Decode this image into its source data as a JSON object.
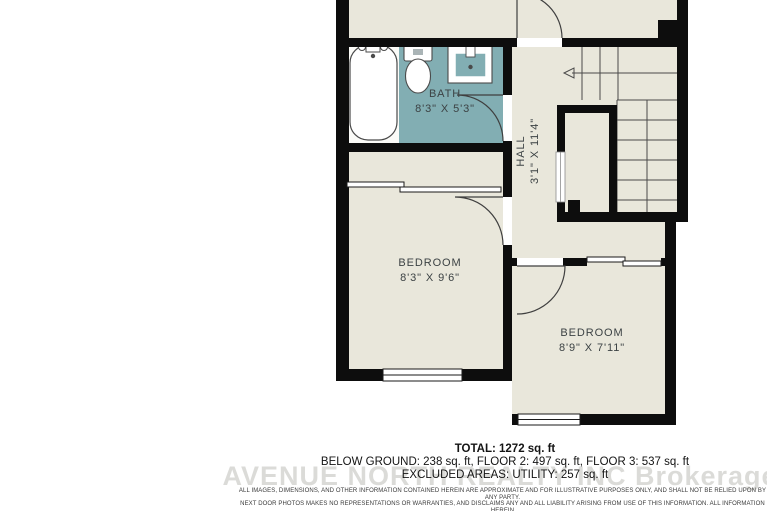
{
  "colors": {
    "wall": "#0d0d0d",
    "floor": "#e9e7db",
    "bath_floor": "#82aeb3",
    "label_text": "#3c4244",
    "watermark_gray": "#b9b9b3"
  },
  "plan": {
    "rooms": {
      "bath": {
        "name": "BATH",
        "dims": "8'3\" X 5'3\""
      },
      "hall": {
        "name": "HALL",
        "dims": "3'1\" X 11'4\""
      },
      "bedroom1": {
        "name": "BEDROOM",
        "dims": "8'3\" X 9'6\""
      },
      "bedroom2": {
        "name": "BEDROOM",
        "dims": "8'9\" X 7'11\""
      }
    },
    "fixtures": [
      "bathtub",
      "toilet",
      "sink-vanity",
      "staircase",
      "doors",
      "windows",
      "closets"
    ]
  },
  "summary": {
    "total": "TOTAL: 1272 sq. ft",
    "floors": "BELOW GROUND: 238 sq. ft, FLOOR 2: 497 sq. ft, FLOOR 3: 537 sq. ft",
    "excluded": "EXCLUDED AREAS: UTILITY: 257 sq. ft"
  },
  "watermark": "AVENUE NORTH REALTY INC Brokerage",
  "disclaimer": {
    "line1": "ALL IMAGES, DIMENSIONS, AND OTHER INFORMATION CONTAINED HEREIN ARE APPROXIMATE AND FOR ILLUSTRATIVE PURPOSES ONLY, AND SHALL NOT BE RELIED UPON BY ANY PARTY.",
    "line2": "NEXT DOOR PHOTOS MAKES NO REPRESENTATIONS OR WARRANTIES, AND DISCLAIMS ANY AND ALL LIABILITY ARISING FROM USE OF THIS INFORMATION. ALL INFORMATION HEREIN",
    "line3": "SHALL BE SUBJECT TO THE TERMS AND CONDITIONS FOUND AT NEXTDOORPHOTOS.COM/TC."
  }
}
